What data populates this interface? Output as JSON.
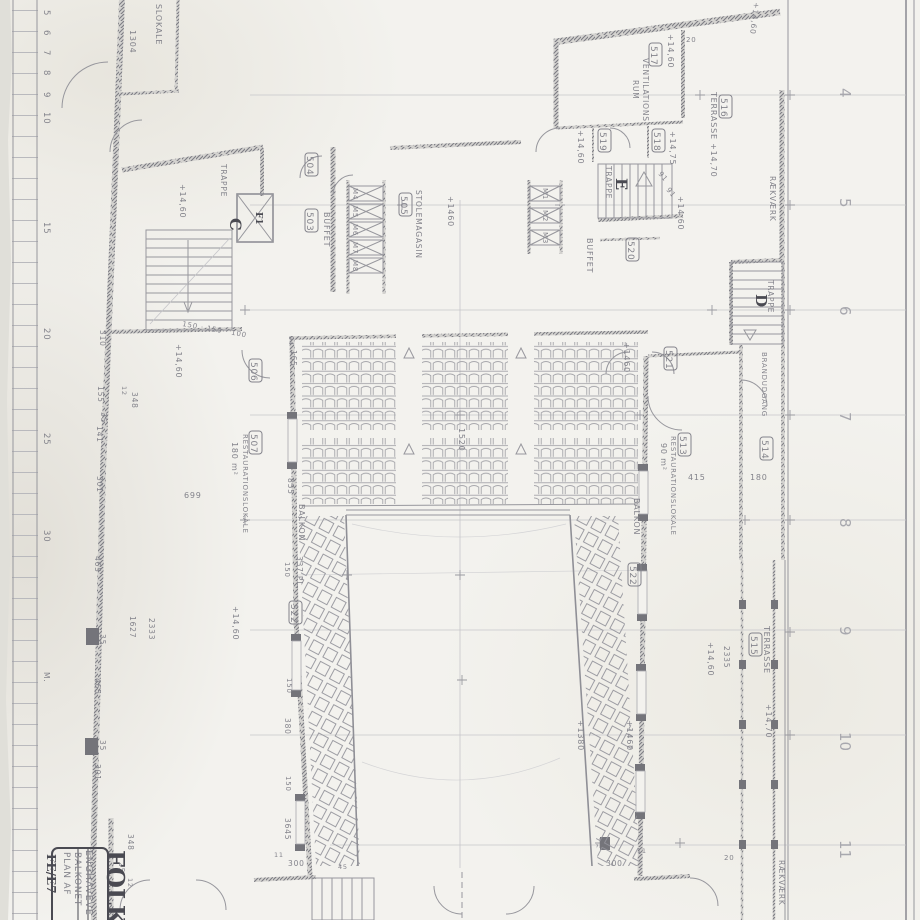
{
  "sheet": {
    "stamp_big": "FOLKE",
    "stamp_addr": "ENGHAVEVE",
    "stamp_l1": "PLAN AF",
    "stamp_l2": "BALKONET",
    "stamp_no": "FE/E7"
  },
  "grid": [
    "4",
    "5",
    "6",
    "7",
    "8",
    "9",
    "10",
    "11"
  ],
  "ruler": {
    "m": [
      "5",
      "6",
      "7",
      "8",
      "9",
      "10",
      "15",
      "20",
      "25",
      "30"
    ],
    "unit": "M."
  },
  "words": {
    "trappe": "TRAPPE",
    "buffet": "BUFFET",
    "balkon": "BALKON",
    "terrasse": "TERRASSE",
    "raekvaerk": "RÆKVÆRK",
    "brandudgang": "BRANDUDGANG",
    "restlokale": "RESTAURATIONSLOKALE",
    "ventilations": "VENTILATIONS",
    "rum": "RUM",
    "stolemagasin": "STOLEMAGASIN",
    "partial_lokale": "SLOKALE"
  },
  "stairs": {
    "c": "C",
    "d": "D",
    "e": "E",
    "lift": "F1"
  },
  "cols": {
    "m1": "M1",
    "m2": "M2",
    "m3": "M3",
    "m4": "M4",
    "m5": "M5",
    "m6": "M6",
    "m7": "M7",
    "m8": "M8"
  },
  "nos": {
    "n503": "503",
    "n504": "504",
    "n505": "505",
    "n506": "506",
    "n507": "507",
    "n513": "513",
    "n514": "514",
    "n515": "515",
    "n516": "516",
    "n517": "517",
    "n518": "518",
    "n519": "519",
    "n520": "520",
    "n521": "521",
    "n522": "522"
  },
  "levels": {
    "l1460": "+14,60",
    "l1470": "+14,70",
    "l1475": "+14,75",
    "p1460": "+1460",
    "p1380": "+1380",
    "t1470": "TERRASSE +14,70"
  },
  "areas": {
    "a507": "180 m²",
    "a513": "90 m²"
  },
  "dims": {
    "d11": "11",
    "d12": "12",
    "d20": "20",
    "d25": "25",
    "d35": "35",
    "d45": "45",
    "d91": "91",
    "d94": "94",
    "d150": "150",
    "d155": "155",
    "d141": "141",
    "d165": "165",
    "d180": "180",
    "d300": "300",
    "d301": "301",
    "d310": "310",
    "d337": "337 PL.",
    "d348": "348",
    "d380": "380",
    "d415": "415",
    "d465": "465",
    "d699": "699",
    "d855": "855",
    "d1304": "1304",
    "d1520": "1520",
    "d1627": "1627",
    "d2333": "2333",
    "d2335": "2335",
    "d3645": "3645",
    "chain": "150 · 150 · 100"
  }
}
